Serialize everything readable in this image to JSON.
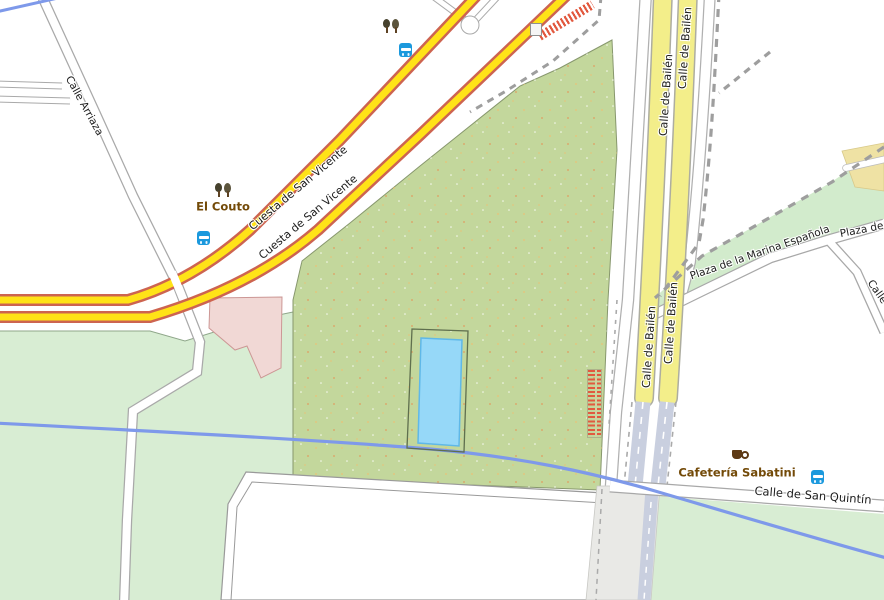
{
  "map_type": "street-map",
  "roads": {
    "calle_arriaza": {
      "label": "Calle Arriaza"
    },
    "cuesta_de_san_vicente": {
      "label": "Cuesta de San Vicente"
    },
    "calle_de_bailen": {
      "label": "Calle de Bailén"
    },
    "plaza_de_la_marina_espanola": {
      "label": "Plaza de la Marina Española"
    },
    "plaza_de_la_partial": {
      "label": "Plaza de la"
    },
    "calle_partial": {
      "label": "Calle"
    },
    "calle_de_san_quintin": {
      "label": "Calle de San Quintín"
    }
  },
  "places": {
    "el_couto": {
      "label": "El Couto"
    },
    "cafeteria_sabatini": {
      "label": "Cafetería Sabatini"
    }
  },
  "icons": {
    "bus_stops": 3,
    "tree_groups": 2,
    "cafe_cup": 1,
    "steps": 2,
    "elevator": 1
  },
  "colors": {
    "park_green": "#c3d79c",
    "light_green": "#d8edd3",
    "plaza_green": "#d2ebcc",
    "primary_road_fill": "#ffe317",
    "primary_road_casing": "#cd6450",
    "bailen_road_fill": "#f3ee8a",
    "water_pool": "#96d8f8",
    "stream": "#7e99ea",
    "building_pink": "#f1d8d5",
    "plaza_beige": "#efe2a4",
    "tunnel_road": "#c9cfdf",
    "poi_label_brown": "#734a08",
    "bus_blue": "#1b99dd",
    "steps_orange": "#e2593f"
  }
}
